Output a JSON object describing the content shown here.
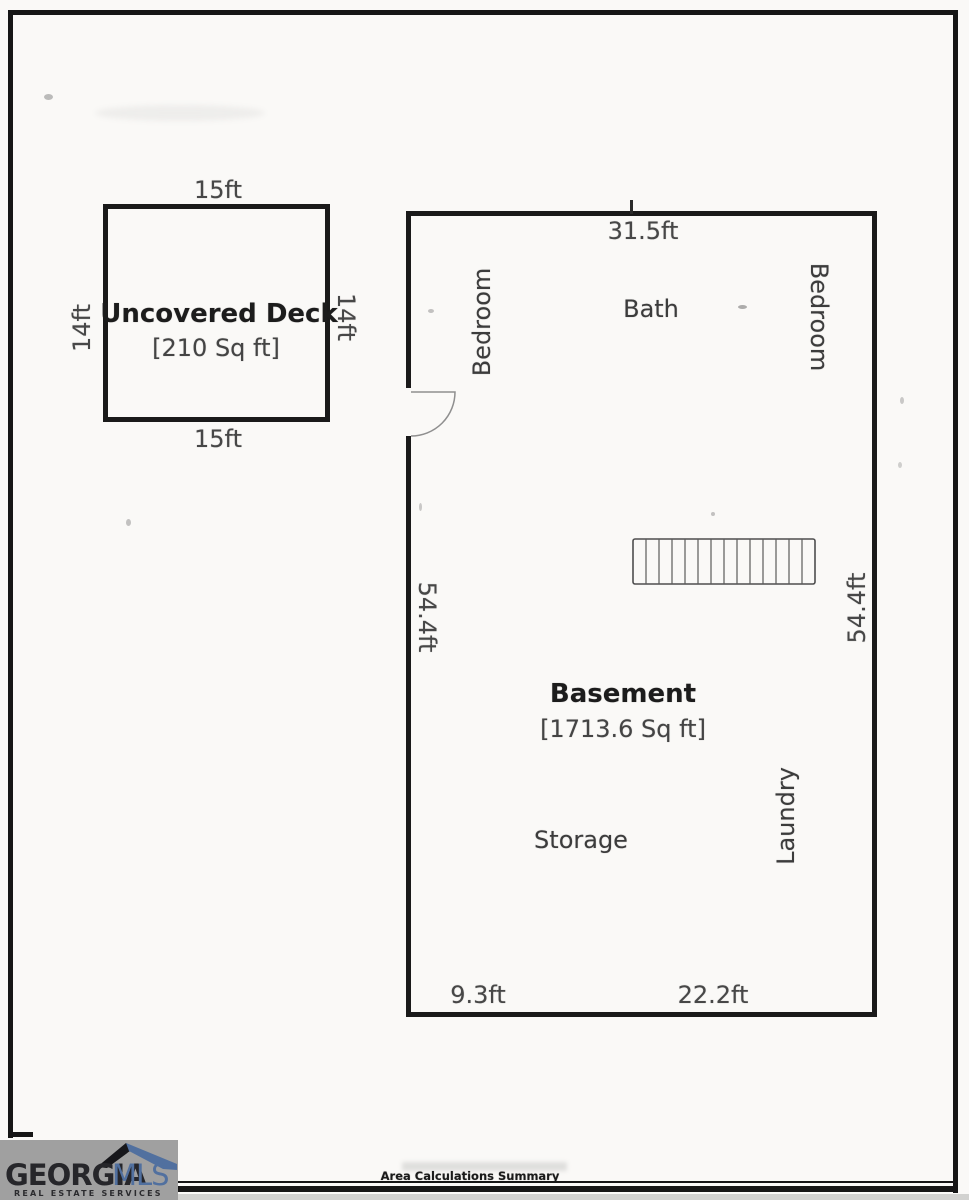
{
  "deck": {
    "label": "Uncovered Deck",
    "area": "[210 Sq ft]",
    "dim_top": "15ft",
    "dim_bottom": "15ft",
    "dim_left": "14ft",
    "dim_right": "14ft"
  },
  "basement": {
    "label": "Basement",
    "area": "[1713.6 Sq ft]",
    "dim_top": "31.5ft",
    "dim_left": "54.4ft",
    "dim_right": "54.4ft",
    "dim_bottom_left": "9.3ft",
    "dim_bottom_right": "22.2ft",
    "room_bedroom_left": "Bedroom",
    "room_bath": "Bath",
    "room_bedroom_right": "Bedroom",
    "room_storage": "Storage",
    "room_laundry": "Laundry"
  },
  "footer": {
    "summary_title": "Area Calculations Summary"
  },
  "logo": {
    "brand_primary": "GEORGIA",
    "brand_secondary": "MLS",
    "tagline": "REAL ESTATE SERVICES",
    "colors": {
      "background": "#a0a0a0",
      "primary_text": "#26262a",
      "secondary_text": "#51709f",
      "roof_dark": "#17171b",
      "roof_blue": "#51709f"
    }
  },
  "colors": {
    "wall": "#1a1a1a",
    "dimension_text": "#474747",
    "room_text": "#3c3c3c",
    "title_text": "#1c1c1c",
    "paper": "#faf9f7"
  }
}
